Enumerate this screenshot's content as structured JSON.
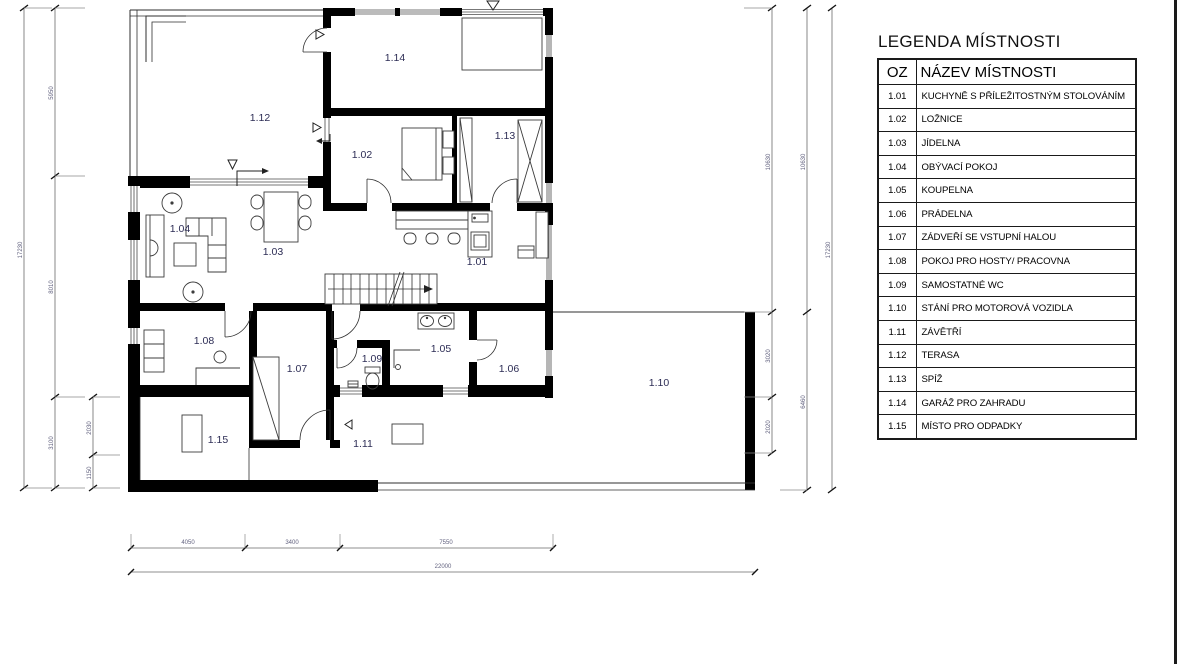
{
  "legend": {
    "title": "LEGENDA MÍSTNOSTI",
    "col_oz": "OZ",
    "col_name": "NÁZEV MÍSTNOSTI",
    "rows": [
      {
        "code": "1.01",
        "name": "KUCHYNĚ S PŘÍLEŽITOSTNÝM STOLOVÁNÍM"
      },
      {
        "code": "1.02",
        "name": "LOŽNICE"
      },
      {
        "code": "1.03",
        "name": "JÍDELNA"
      },
      {
        "code": "1.04",
        "name": "OBÝVACÍ POKOJ"
      },
      {
        "code": "1.05",
        "name": "KOUPELNA"
      },
      {
        "code": "1.06",
        "name": "PRÁDELNA"
      },
      {
        "code": "1.07",
        "name": "ZÁDVEŘÍ SE VSTUPNÍ HALOU"
      },
      {
        "code": "1.08",
        "name": "POKOJ PRO HOSTY/ PRACOVNA"
      },
      {
        "code": "1.09",
        "name": "SAMOSTATNÉ WC"
      },
      {
        "code": "1.10",
        "name": "STÁNÍ PRO MOTOROVÁ VOZIDLA"
      },
      {
        "code": "1.11",
        "name": "ZÁVĚTŘÍ"
      },
      {
        "code": "1.12",
        "name": "TERASA"
      },
      {
        "code": "1.13",
        "name": "SPÍŽ"
      },
      {
        "code": "1.14",
        "name": "GARÁŽ PRO ZAHRADU"
      },
      {
        "code": "1.15",
        "name": "MÍSTO PRO ODPADKY"
      }
    ]
  },
  "dims": {
    "left_total": "17230",
    "left_top": "5950",
    "left_mid": "8010",
    "left_low": "3100",
    "left_in_a": "2030",
    "left_in_b": "1150",
    "right_a_top": "10630",
    "right_a_mid": "3020",
    "right_a_low": "2020",
    "right_b_top": "10630",
    "right_b_low": "6460",
    "right_total": "17230",
    "bottom_a": "4050",
    "bottom_b": "3400",
    "bottom_c": "7550",
    "bottom_total": "22000"
  },
  "colors": {
    "wall": "#000000",
    "room_label": "#2d2d55",
    "dim_text": "#62627f"
  }
}
